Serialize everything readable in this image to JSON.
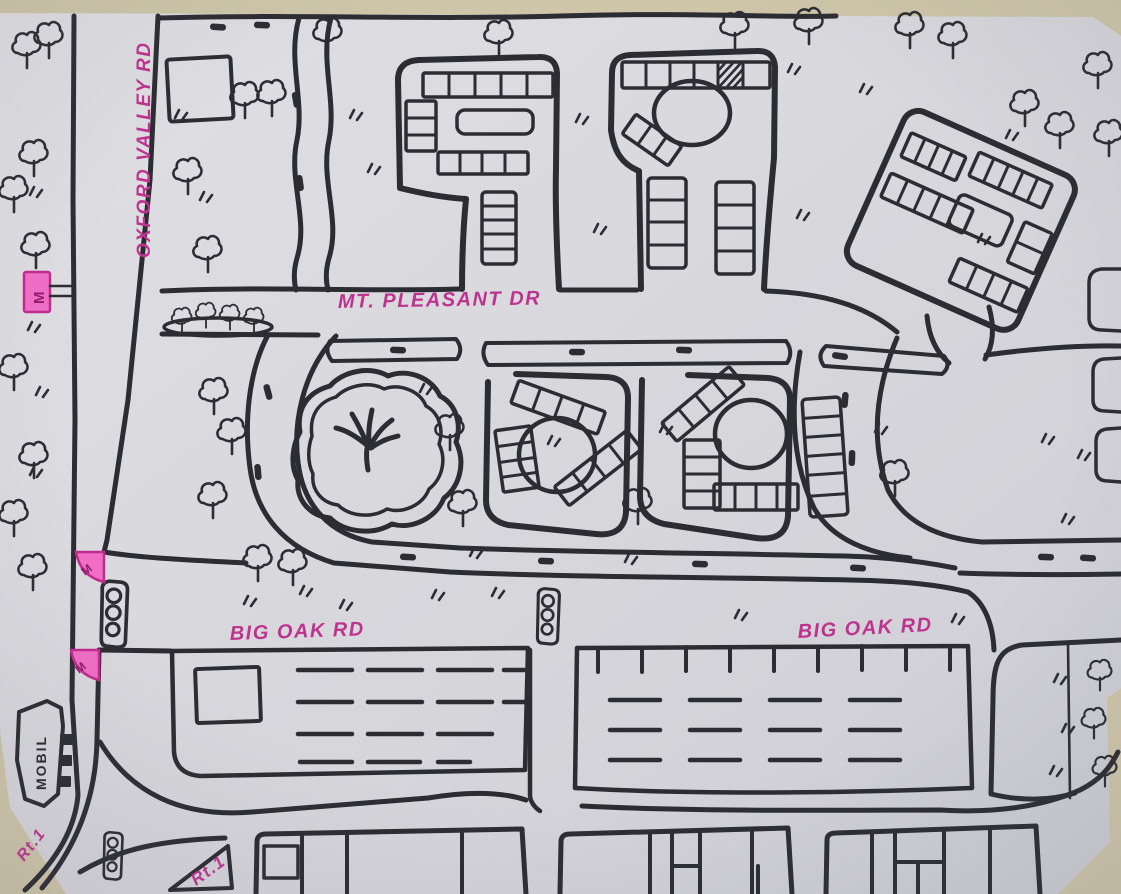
{
  "map": {
    "description": "Hand-drawn neighborhood street map, black marker on paper with pink road labels",
    "road_labels": {
      "oxford_valley": "OXFORD VALLEY RD",
      "mt_pleasant": "MT. PLEASANT DR",
      "big_oak_west": "BIG OAK RD",
      "big_oak_east": "BIG OAK RD",
      "rt1_corner": "Rt.1",
      "rt1_lower": "Rt.1"
    },
    "poi": {
      "gas_station": "MOBIL"
    },
    "markers": {
      "m1": "M",
      "m2": "M",
      "m3": "M"
    },
    "colors": {
      "backdrop": "#cfc6a9",
      "paper": "#d7d7dc",
      "ink": "#2c2c33",
      "label_pink": "#bf3390",
      "marker_pink": "#f06ec6"
    }
  }
}
